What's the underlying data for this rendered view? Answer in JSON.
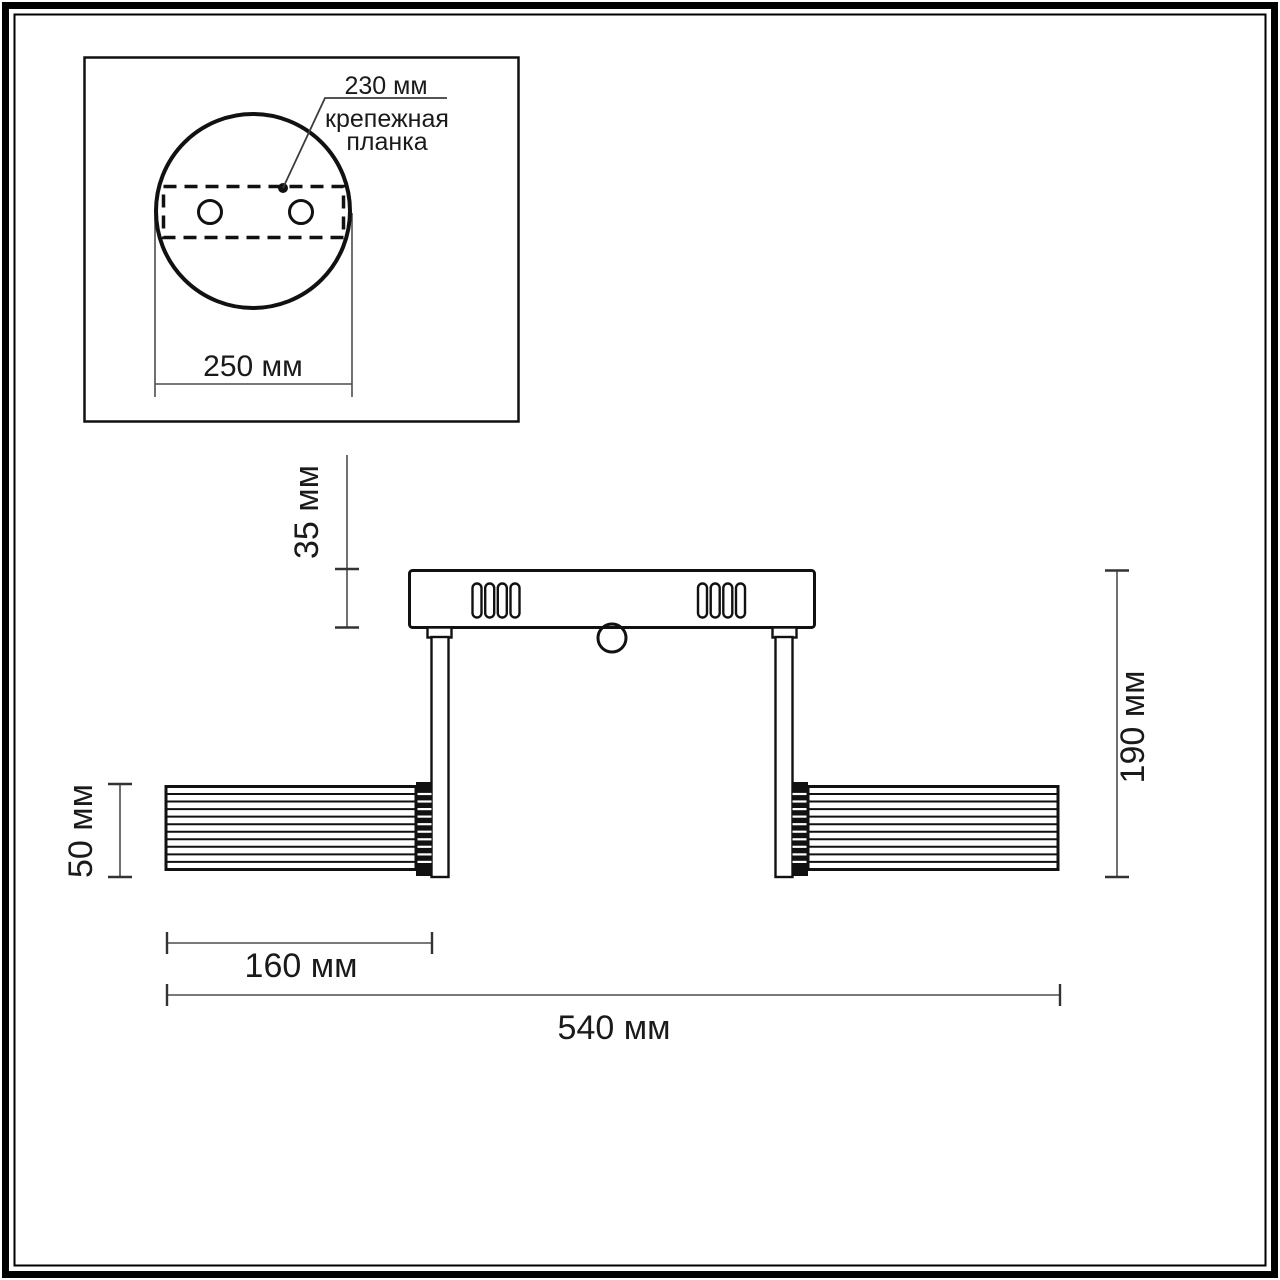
{
  "inset": {
    "hole_spacing_label": "230 мм",
    "mounting_bar_label_line1": "крепежная",
    "mounting_bar_label_line2": "планка",
    "plate_width_label": "250 мм"
  },
  "front_view": {
    "canopy_height_label": "35 мм",
    "shade_diameter_label": "50 мм",
    "fixture_height_label": "190 мм",
    "shade_length_label": "160 мм",
    "fixture_width_label": "540 мм"
  },
  "colors": {
    "line": "#111111",
    "dimension_line": "#4d4d4d",
    "background": "#ffffff"
  }
}
